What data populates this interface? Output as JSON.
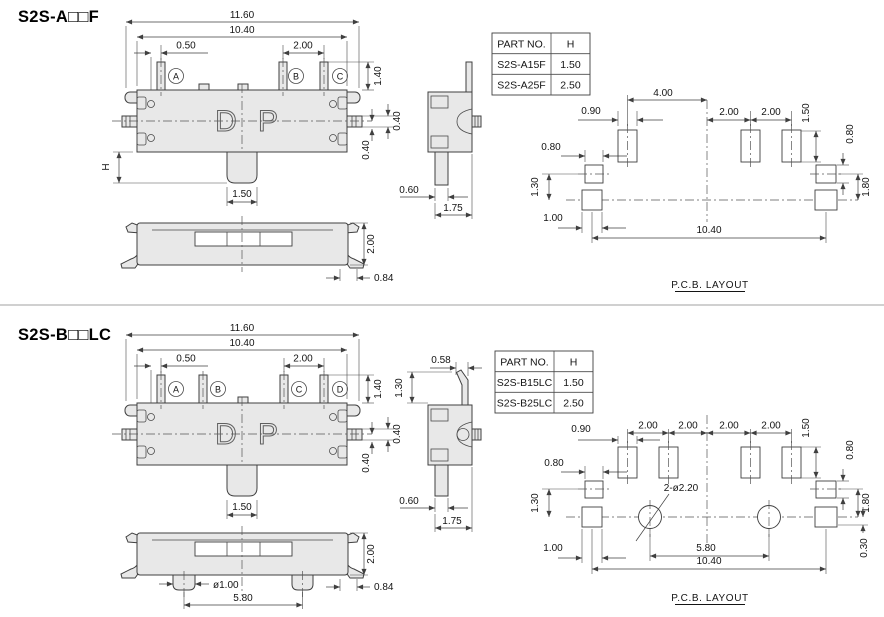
{
  "sections": [
    {
      "title": "S2S-A□□F",
      "front": {
        "w_total": "11.60",
        "w_body": "10.40",
        "pin_offset": "0.50",
        "pin_pitch": "2.00",
        "pins": [
          "A",
          "B",
          "C"
        ],
        "mark_d": "D",
        "mark_p": "P",
        "pin_h": "1.40",
        "side_pin": "0.40",
        "center_off": "0.40",
        "knob_h": "H",
        "knob_w": "1.50"
      },
      "bottom": {
        "height": "2.00",
        "foot": "0.84"
      },
      "side": {
        "stem": "0.60",
        "depth": "1.75"
      },
      "table": {
        "col_part": "PART NO.",
        "col_h": "H",
        "rows": [
          {
            "part": "S2S-A15F",
            "h": "1.50"
          },
          {
            "part": "S2S-A25F",
            "h": "2.50"
          }
        ]
      },
      "pcb": {
        "gap": "4.00",
        "pad_w": "0.90",
        "pitch1": "2.00",
        "pitch2": "2.00",
        "pad_h": "1.50",
        "r_pad": "0.80",
        "r_off": "1.80",
        "l_pad": "0.80",
        "l_off": "1.30",
        "b_pad": "1.00",
        "total": "10.40",
        "label": "P.C.B. LAYOUT"
      }
    },
    {
      "title": "S2S-B□□LC",
      "front": {
        "w_total": "11.60",
        "w_body": "10.40",
        "pin_offset": "0.50",
        "pin_pitch": "2.00",
        "pins": [
          "A",
          "B",
          "C",
          "D"
        ],
        "mark_d": "D",
        "mark_p": "P",
        "pin_h": "1.40",
        "side_pin": "0.40",
        "center_off": "0.40",
        "knob_w": "1.50"
      },
      "bottom": {
        "height": "2.00",
        "foot": "0.84",
        "boss_dia": "ø1.00",
        "boss_span": "5.80"
      },
      "side": {
        "lead_off": "0.58",
        "lead_h": "1.30",
        "stem": "0.60",
        "depth": "1.75"
      },
      "table": {
        "col_part": "PART NO.",
        "col_h": "H",
        "rows": [
          {
            "part": "S2S-B15LC",
            "h": "1.50"
          },
          {
            "part": "S2S-B25LC",
            "h": "2.50"
          }
        ]
      },
      "pcb": {
        "pitches": [
          "2.00",
          "2.00",
          "2.00",
          "2.00"
        ],
        "pad_w": "0.90",
        "pad_h": "1.50",
        "r_pad": "0.80",
        "r_off": "1.80",
        "hole_off": "0.30",
        "l_pad": "0.80",
        "l_off": "1.30",
        "b_pad": "1.00",
        "note": "2-ø2.20",
        "span": "5.80",
        "total": "10.40",
        "label": "P.C.B. LAYOUT"
      }
    }
  ]
}
